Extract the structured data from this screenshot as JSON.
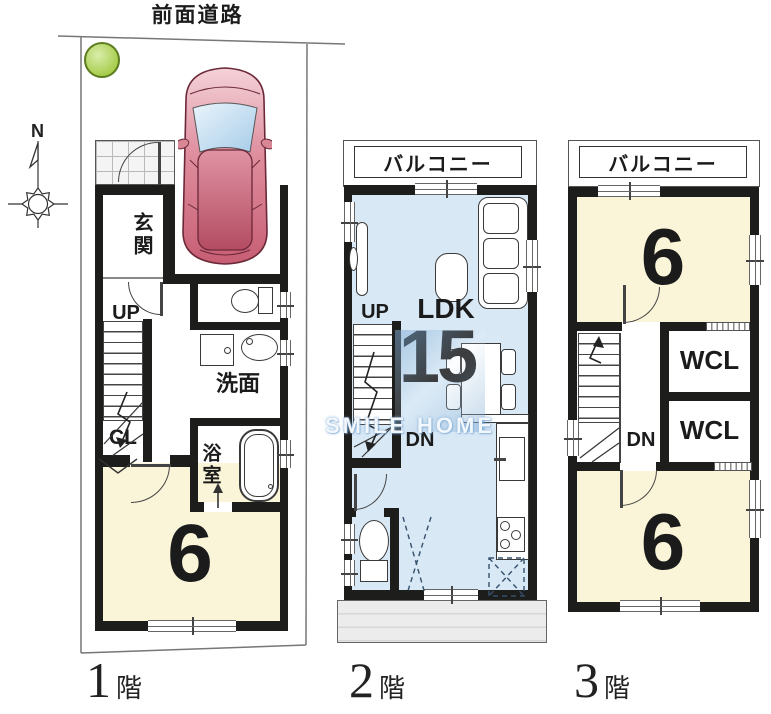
{
  "site": {
    "road_label": "前面道路",
    "compass_label": "N"
  },
  "watermark": {
    "text_left": "SMILE",
    "text_right": "HOME"
  },
  "floor1": {
    "floor_num": "1",
    "floor_suffix": "階",
    "genkan": "玄関",
    "up": "UP",
    "cl": "CL",
    "senmen": "洗面",
    "bath": "浴室",
    "tatami": "6"
  },
  "floor2": {
    "floor_num": "2",
    "floor_suffix": "階",
    "balcony": "バルコニー",
    "up": "UP",
    "dn": "DN",
    "ldk": "LDK",
    "ldk_size": "15"
  },
  "floor3": {
    "floor_num": "3",
    "floor_suffix": "階",
    "balcony": "バルコニー",
    "tatami_top": "6",
    "wcl_top": "WCL",
    "wcl_bottom": "WCL",
    "dn": "DN",
    "tatami_bottom": "6"
  },
  "colors": {
    "wall": "#1d1d1b",
    "room_cream": "#FAF5D9",
    "room_blue": "#D8E8F5",
    "eave_gray": "#ECECEC",
    "tree_green": "#A9CE4F",
    "car_pink": "#D87083"
  }
}
